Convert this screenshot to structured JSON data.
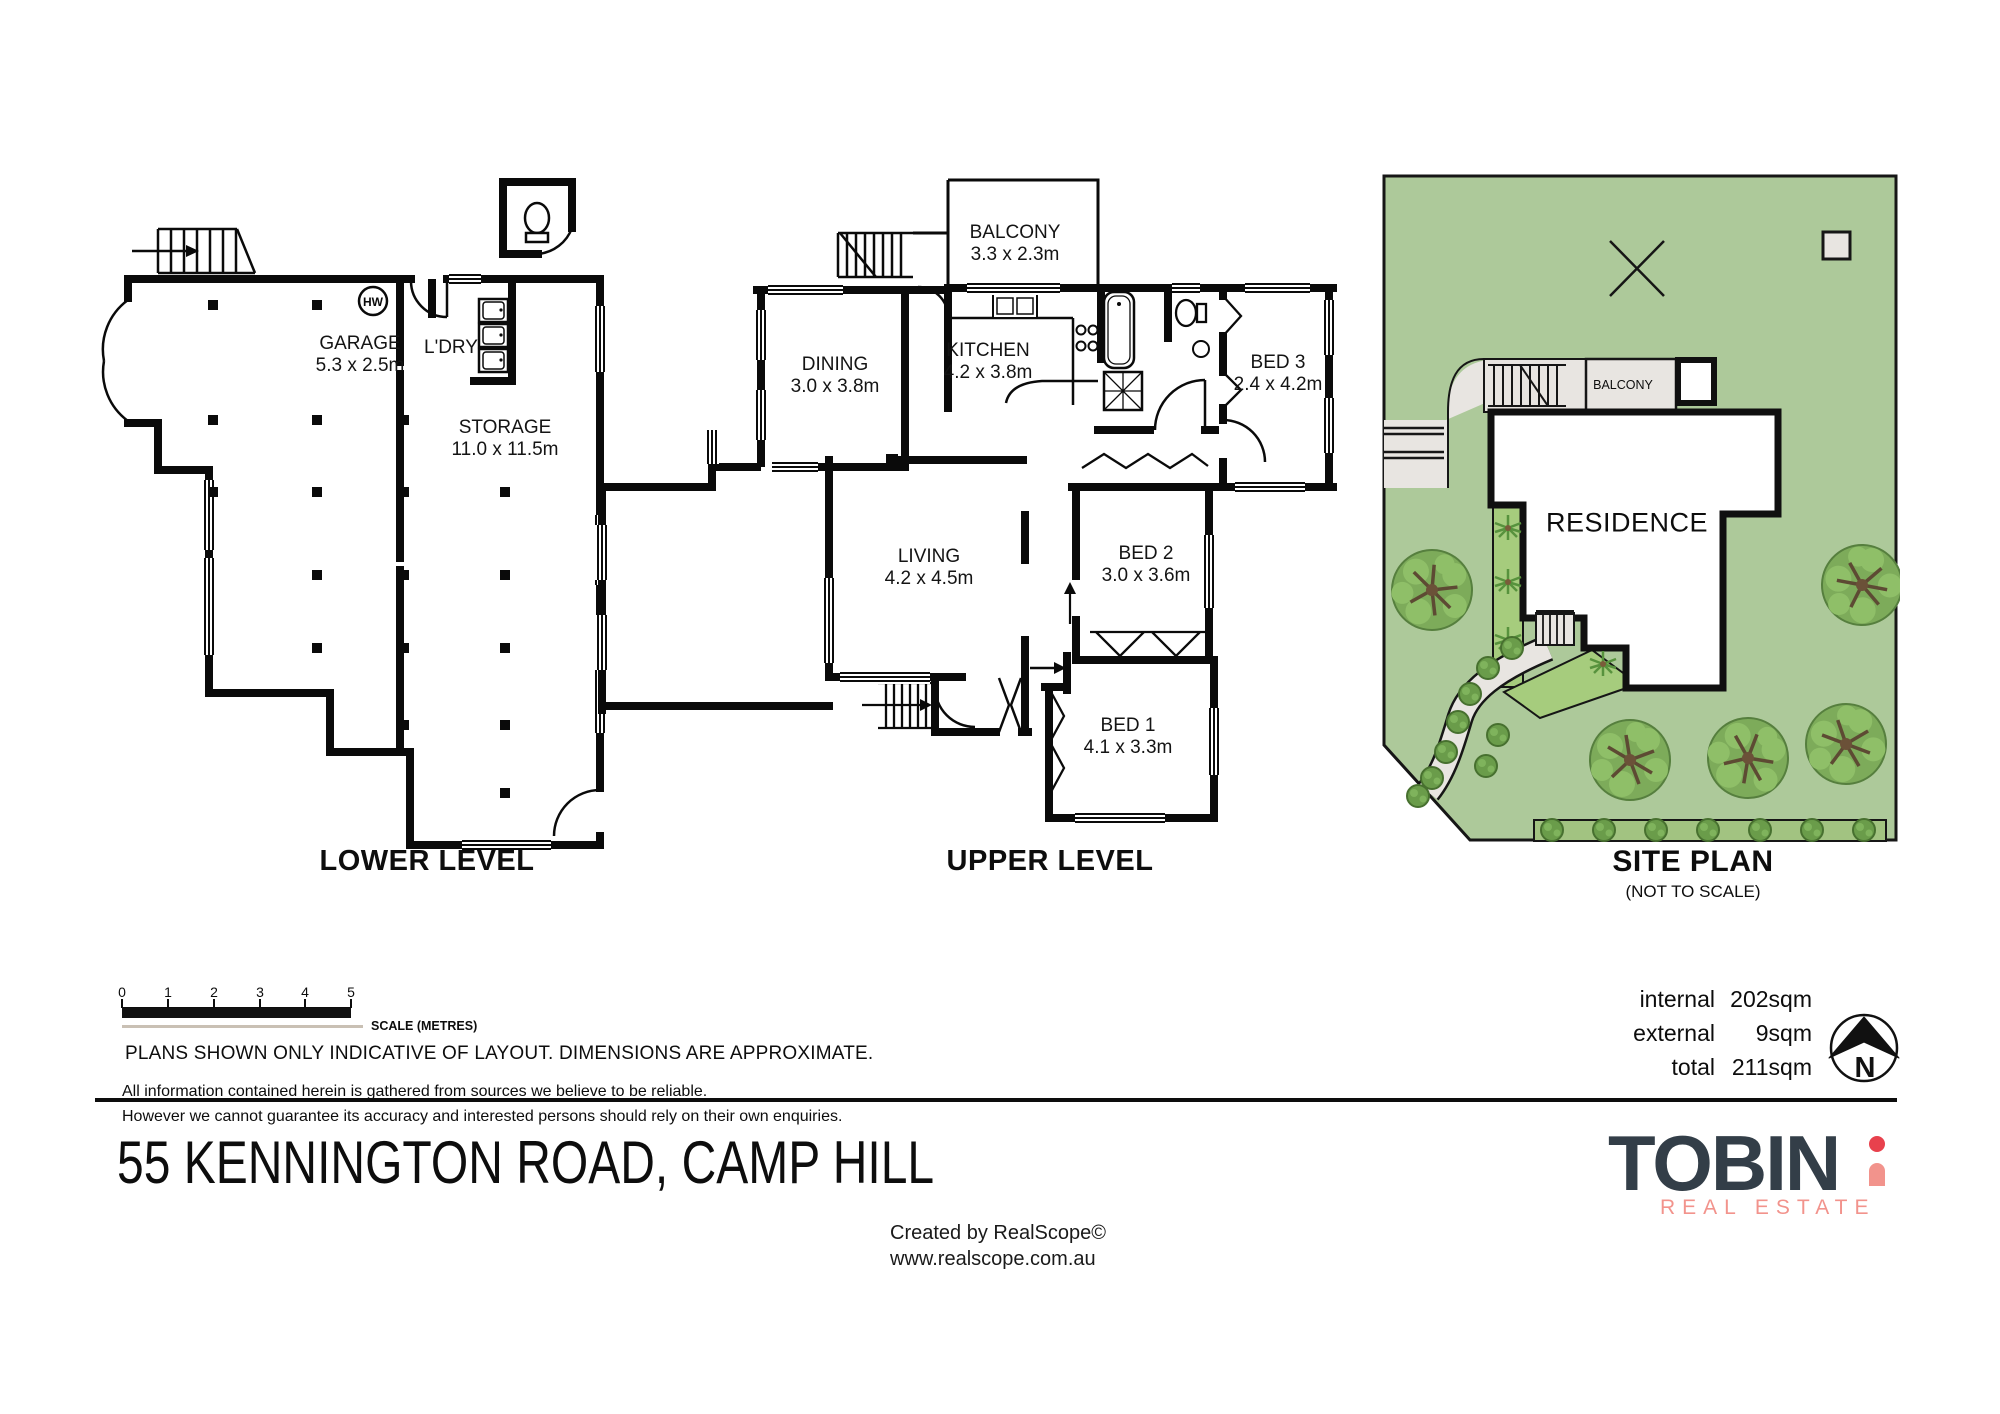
{
  "plans": {
    "lower": {
      "title": "LOWER LEVEL",
      "hw": "HW",
      "rooms": [
        {
          "name": "GARAGE",
          "dims": "5.3 x 2.5m"
        },
        {
          "name": "L'DRY",
          "dims": ""
        },
        {
          "name": "STORAGE",
          "dims": "11.0 x 11.5m"
        }
      ]
    },
    "upper": {
      "title": "UPPER LEVEL",
      "rooms": [
        {
          "name": "BALCONY",
          "dims": "3.3 x 2.3m"
        },
        {
          "name": "DINING",
          "dims": "3.0 x 3.8m"
        },
        {
          "name": "KITCHEN",
          "dims": "4.2 x 3.8m"
        },
        {
          "name": "BED 3",
          "dims": "2.4 x 4.2m"
        },
        {
          "name": "LIVING",
          "dims": "4.2 x 4.5m"
        },
        {
          "name": "BED 2",
          "dims": "3.0 x 3.6m"
        },
        {
          "name": "BED 1",
          "dims": "4.1 x 3.3m"
        }
      ]
    },
    "site": {
      "title": "SITE PLAN",
      "subtitle": "(NOT TO SCALE)",
      "residence": "RESIDENCE",
      "balcony": "BALCONY"
    }
  },
  "scale_bar": {
    "ticks": [
      "0",
      "1",
      "2",
      "3",
      "4",
      "5"
    ],
    "caption": "SCALE (METRES)"
  },
  "notes": {
    "headline": "PLANS SHOWN ONLY INDICATIVE OF LAYOUT.  DIMENSIONS ARE APPROXIMATE.",
    "fine1": "All information contained herein is gathered from sources we believe to be reliable.",
    "fine2": "However we cannot guarantee its accuracy and interested persons should rely on their own enquiries."
  },
  "areas": {
    "rows": [
      {
        "label": "internal",
        "value": "202sqm"
      },
      {
        "label": "external",
        "value": "9sqm"
      },
      {
        "label": "total",
        "value": "211sqm"
      }
    ]
  },
  "compass": {
    "label": "N"
  },
  "address": "55 KENNINGTON ROAD, CAMP HILL",
  "credit": {
    "line1": "Created by RealScope©",
    "line2": "www.realscope.com.au"
  },
  "brand": {
    "wordmark": "TOBIN",
    "tagline": "REAL ESTATE"
  },
  "colors": {
    "wall": "#0a0a0a",
    "site_green": "#adc99a",
    "garden_green": "#a6cc7d",
    "hedge_green": "#a2c381",
    "tree_green": "#7dab5a",
    "path_grey": "#e8e5e1",
    "brand_navy": "#333e48",
    "brand_red": "#e8414d",
    "brand_pink": "#f2938c"
  }
}
